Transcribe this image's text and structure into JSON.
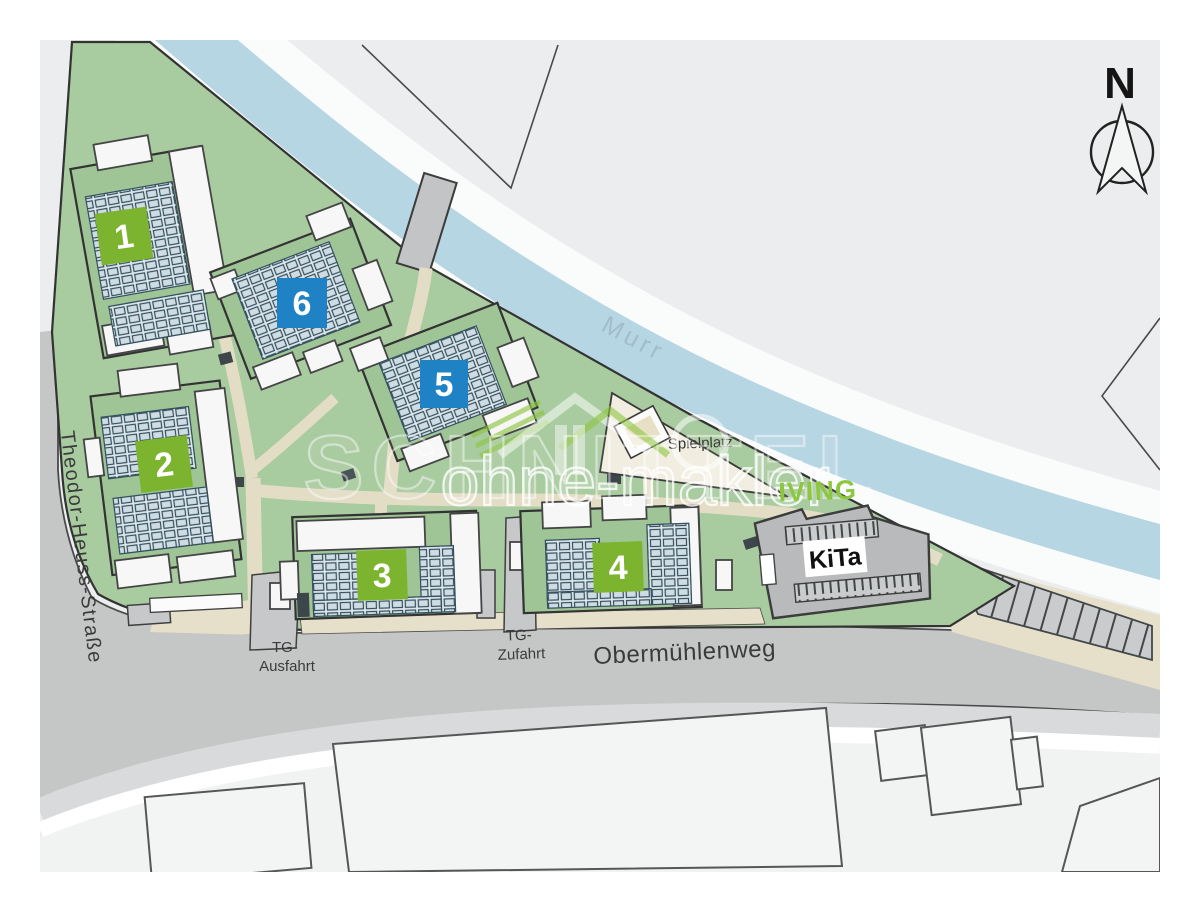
{
  "compass": {
    "label": "N"
  },
  "river": {
    "label": "Murr"
  },
  "streets": {
    "left": "Theodor-Heuss-Straße",
    "south": "Obermühlenweg"
  },
  "garage": {
    "exit_line1": "TG-",
    "exit_line2": "Ausfahrt",
    "entry_line1": "TG-",
    "entry_line2": "Zufahrt"
  },
  "playground": {
    "label": "Spielplatz"
  },
  "kita": {
    "label": "KiTa"
  },
  "buildings": [
    {
      "number": "1",
      "badge_color": "#7cb32f"
    },
    {
      "number": "2",
      "badge_color": "#7cb32f"
    },
    {
      "number": "3",
      "badge_color": "#7cb32f"
    },
    {
      "number": "4",
      "badge_color": "#7cb32f"
    },
    {
      "number": "5",
      "badge_color": "#1e82c4"
    },
    {
      "number": "6",
      "badge_color": "#1e82c4"
    }
  ],
  "watermark": {
    "brand_outline_text": "SCHNITTEL",
    "listing_text": "ohne-makler",
    "green_text": "IVING",
    "green_color": "#8dc63f"
  },
  "colors": {
    "site_green": "#a9cba0",
    "roof_green": "#9fc496",
    "water_blue": "#b7d6e4",
    "road_gray": "#c5c7c7",
    "path_beige": "#e4ddc6",
    "badge_green": "#7cb32f",
    "badge_blue": "#1e82c4",
    "background_gray": "#ecedee"
  }
}
